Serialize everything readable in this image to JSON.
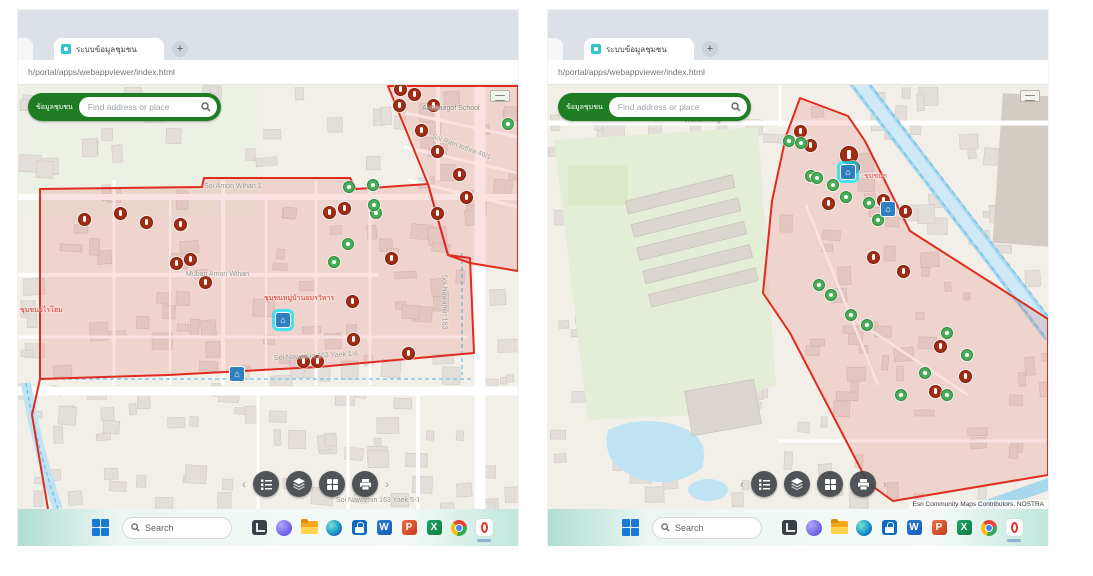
{
  "browser": {
    "tab_title": "ระบบข้อมูลชุมชน",
    "new_tab": "+",
    "url": "h/portal/apps/webappviewer/index.html"
  },
  "app": {
    "title": "ข้อมูลชุมชน",
    "search_placeholder": "Find address or place"
  },
  "dock": {
    "prev": "‹",
    "next": "›",
    "buttons": [
      {
        "name": "legend"
      },
      {
        "name": "layers"
      },
      {
        "name": "basemap-gallery"
      },
      {
        "name": "print"
      }
    ]
  },
  "taskbar": {
    "search_label": "Search",
    "apps": [
      {
        "name": "taskview"
      },
      {
        "name": "copilot"
      },
      {
        "name": "file-explorer"
      },
      {
        "name": "edge"
      },
      {
        "name": "store"
      },
      {
        "name": "word"
      },
      {
        "name": "powerpoint"
      },
      {
        "name": "excel"
      },
      {
        "name": "chrome"
      },
      {
        "name": "opera",
        "active": true
      }
    ]
  },
  "colors": {
    "boundary": "#e02b20",
    "incident_marker": "#a22d15",
    "ok_marker": "#49ae59",
    "search_green": "#1e7d22",
    "water": "#bfe3f2"
  },
  "maps": [
    {
      "side": "left",
      "attribution": "",
      "polygons": [
        {
          "points": "22,104 184,102 186,93 332,93 338,104 410,99 430,170 452,173 456,268 300,282 150,290 22,294"
        },
        {
          "points": "370,1 500,1 500,186 452,178 430,170 410,99"
        },
        {
          "points": "22,294 14,330 30,424",
          "closed": false
        }
      ],
      "red_markers": [
        [
          382,
          4
        ],
        [
          396,
          9
        ],
        [
          381,
          20
        ],
        [
          415,
          20
        ],
        [
          403,
          45
        ],
        [
          419,
          66
        ],
        [
          441,
          89
        ],
        [
          448,
          112
        ],
        [
          419,
          128
        ],
        [
          326,
          123
        ],
        [
          311,
          127
        ],
        [
          373,
          173
        ],
        [
          334,
          216
        ],
        [
          335,
          254
        ],
        [
          102,
          128
        ],
        [
          66,
          134
        ],
        [
          128,
          137
        ],
        [
          162,
          139
        ],
        [
          158,
          178
        ],
        [
          172,
          174
        ],
        [
          187,
          197
        ],
        [
          285,
          276
        ],
        [
          299,
          276
        ],
        [
          390,
          268
        ]
      ],
      "green_markers": [
        [
          330,
          101
        ],
        [
          354,
          99
        ],
        [
          357,
          127
        ],
        [
          329,
          158
        ],
        [
          315,
          176
        ],
        [
          489,
          38
        ],
        [
          355,
          119
        ]
      ],
      "poi_markers": [
        {
          "x": 264,
          "y": 234,
          "selected": true
        },
        {
          "x": 218,
          "y": 288
        }
      ],
      "labels": [
        {
          "text": "Al-Asaagof School",
          "x": 404,
          "y": 20,
          "color": "#8a8378"
        },
        {
          "text": "Muban Amon Wihan",
          "x": 168,
          "y": 186,
          "color": "#9a948a"
        },
        {
          "text": "Soi Amon Wihan 1",
          "x": 186,
          "y": 98,
          "color": "#9a948a"
        },
        {
          "text": "Soi Nawamin 163 Yaek 1-6",
          "x": 256,
          "y": 270,
          "color": "#9a948a",
          "rot": -3
        },
        {
          "text": "Soi Nawamin 163",
          "x": 426,
          "y": 186,
          "color": "#9a948a",
          "rot": 90
        },
        {
          "text": "Soi Ram Inthra 46/1",
          "x": 414,
          "y": 48,
          "color": "#9a948a",
          "rot": 20
        },
        {
          "text": "ชุมชนหมู่บ้านอมรวิหาร",
          "x": 246,
          "y": 208,
          "color": "#e02b20"
        },
        {
          "text": "ชุมชนวไรโฮม",
          "x": 2,
          "y": 220,
          "color": "#e02b20"
        },
        {
          "text": "Soi Nawamin 163 Yaek 5-1",
          "x": 318,
          "y": 412,
          "color": "#9a948a"
        }
      ]
    },
    {
      "side": "right",
      "attribution": "Esri Community Maps Contributors, NOSTRA",
      "polygons": [
        {
          "points": "252,13 300,31 317,56 362,146 500,234 500,390 345,416 320,398 242,248 215,208 224,116 238,51"
        }
      ],
      "red_markers": [
        [
          252,
          46
        ],
        [
          262,
          60
        ],
        {
          "x": 301,
          "y": 70,
          "big": true
        },
        [
          305,
          82
        ],
        [
          280,
          118
        ],
        [
          335,
          115
        ],
        [
          357,
          126
        ],
        [
          325,
          172
        ],
        [
          355,
          186
        ],
        [
          392,
          261
        ],
        [
          417,
          291
        ],
        [
          387,
          306
        ]
      ],
      "green_markers": [
        [
          240,
          55
        ],
        [
          252,
          57
        ],
        [
          262,
          90
        ],
        [
          268,
          92
        ],
        [
          284,
          99
        ],
        [
          297,
          111
        ],
        [
          320,
          117
        ],
        [
          329,
          134
        ],
        [
          270,
          199
        ],
        [
          282,
          209
        ],
        [
          302,
          229
        ],
        [
          318,
          239
        ],
        [
          398,
          247
        ],
        [
          418,
          269
        ],
        [
          376,
          287
        ],
        [
          352,
          309
        ],
        [
          398,
          309
        ]
      ],
      "poi_markers": [
        {
          "x": 299,
          "y": 86,
          "selected": true
        },
        {
          "x": 339,
          "y": 123
        }
      ],
      "labels": [
        {
          "text": "Wanon Rng",
          "x": 136,
          "y": 32,
          "color": "#9a948a"
        },
        {
          "text": "ชุมชนฯ",
          "x": 316,
          "y": 86,
          "color": "#e0484e"
        }
      ]
    }
  ]
}
